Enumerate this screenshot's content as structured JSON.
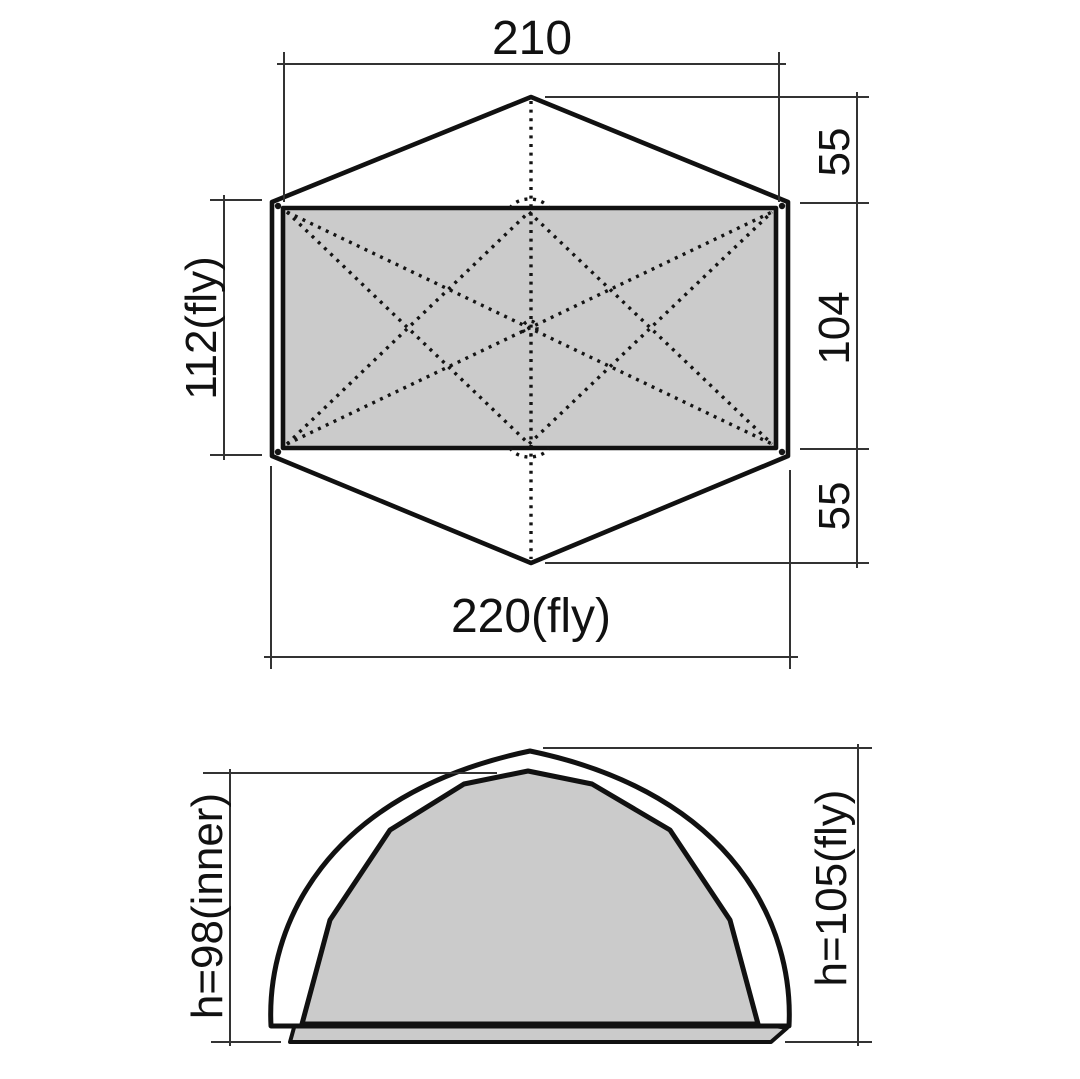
{
  "diagram": {
    "description": "Tent dimension drawing: plan view (top) and end elevation (bottom)",
    "top_view": {
      "dim_top_width": "210",
      "dim_right_upper": "55",
      "dim_right_middle": "104",
      "dim_right_lower": "55",
      "dim_left_depth": "112(fly)",
      "dim_bottom_width": "220(fly)"
    },
    "side_view": {
      "dim_inner_height": "h=98(inner)",
      "dim_fly_height": "h=105(fly)"
    },
    "colors": {
      "background": "#ffffff",
      "outline": "#111111",
      "fabric_gray": "#cbcbcb",
      "dimension_lines": "#333333"
    }
  }
}
